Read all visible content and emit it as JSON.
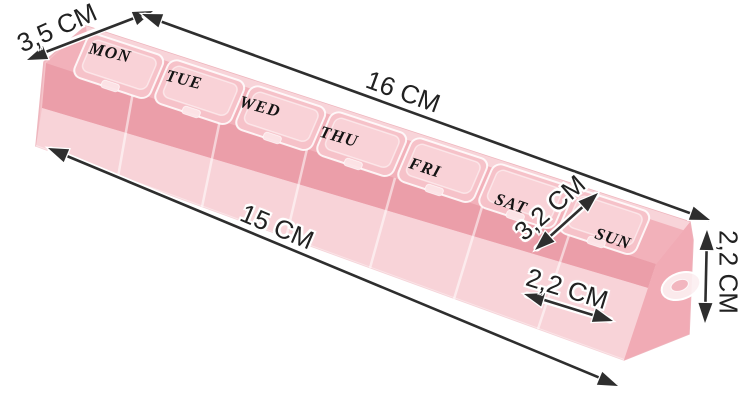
{
  "product": {
    "type_hint": "weekly-pill-organizer-photo",
    "days": [
      "MON",
      "TUE",
      "WED",
      "THU",
      "FRI",
      "SAT",
      "SUN"
    ]
  },
  "dimensions": {
    "depth": "3,5 CM",
    "outer_length": "16 CM",
    "inner_length": "15 CM",
    "compartment_diagonal": "3,2 CM",
    "compartment_width": "2,2 CM",
    "height": "2,2 CM"
  },
  "colors": {
    "background": "#ffffff",
    "box_top": "#f2b1ba",
    "box_interior": "#eb9ea9",
    "box_front": "#f8d3d8",
    "lid": "#f6c2c9",
    "arrow": "#2e2e2e"
  }
}
